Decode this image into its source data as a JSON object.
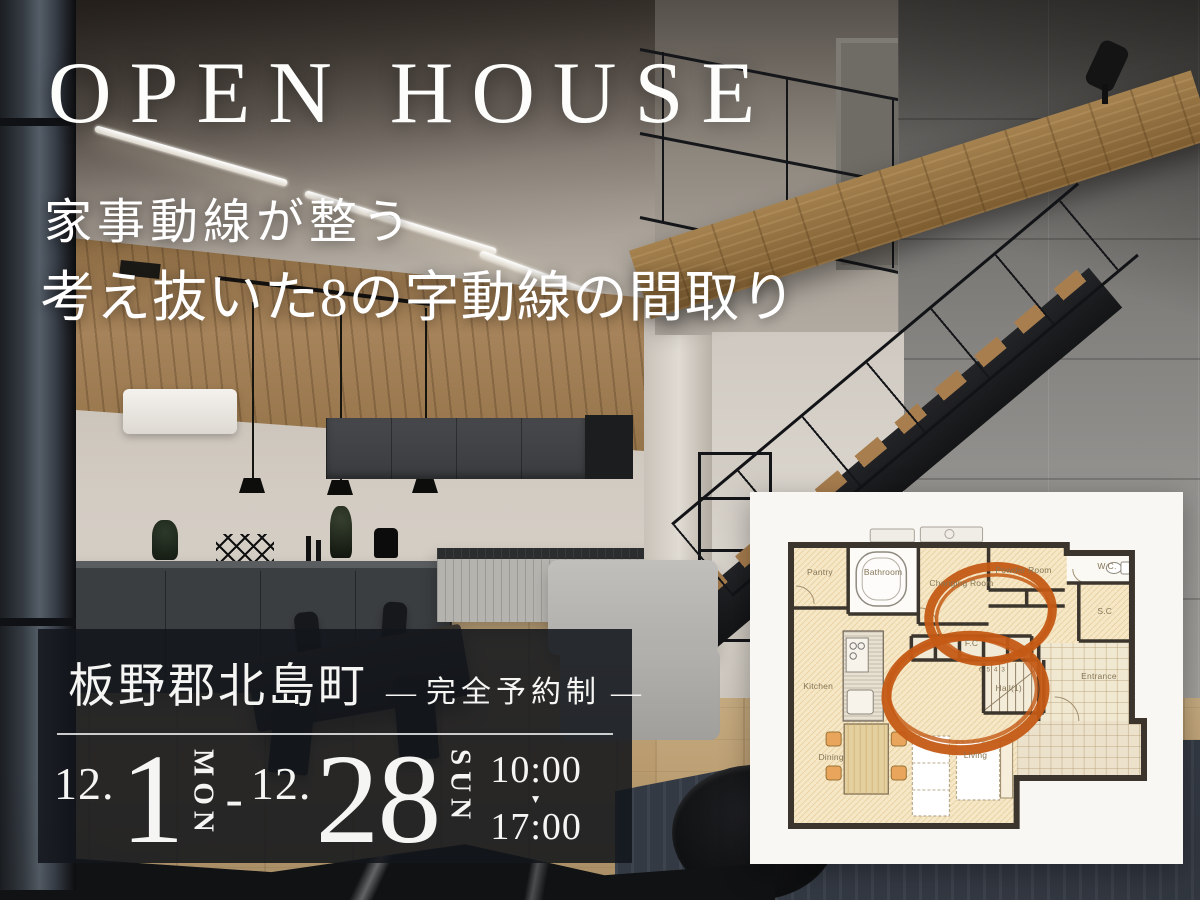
{
  "poster": {
    "title": "OPEN HOUSE",
    "catch_line1": "家事動線が整う",
    "catch_line2": "考え抜いた8の字動線の間取り"
  },
  "event": {
    "location": "板野郡北島町",
    "dash": "—",
    "reservation": "完全予約制",
    "start": {
      "month": "12.",
      "day": "1",
      "weekday": "MON"
    },
    "range_separator": "-",
    "end": {
      "month": "12.",
      "day": "28",
      "weekday": "SUN"
    },
    "time": {
      "open": "10:00",
      "to": "▼",
      "close": "17:00"
    }
  },
  "floor_plan": {
    "highlight_color": "#c45a15",
    "rooms": [
      {
        "label": "Pantry"
      },
      {
        "label": "Bathroom"
      },
      {
        "label": "Changing Room"
      },
      {
        "label": "Powder Room"
      },
      {
        "label": "W.C."
      },
      {
        "label": "S.C"
      },
      {
        "label": "Entrance"
      },
      {
        "label": "Hall(1)"
      },
      {
        "label": "F.C"
      },
      {
        "label": "Kitchen"
      },
      {
        "label": "Dining"
      },
      {
        "label": "Living"
      },
      {
        "label": "6 5 4 3"
      }
    ]
  }
}
